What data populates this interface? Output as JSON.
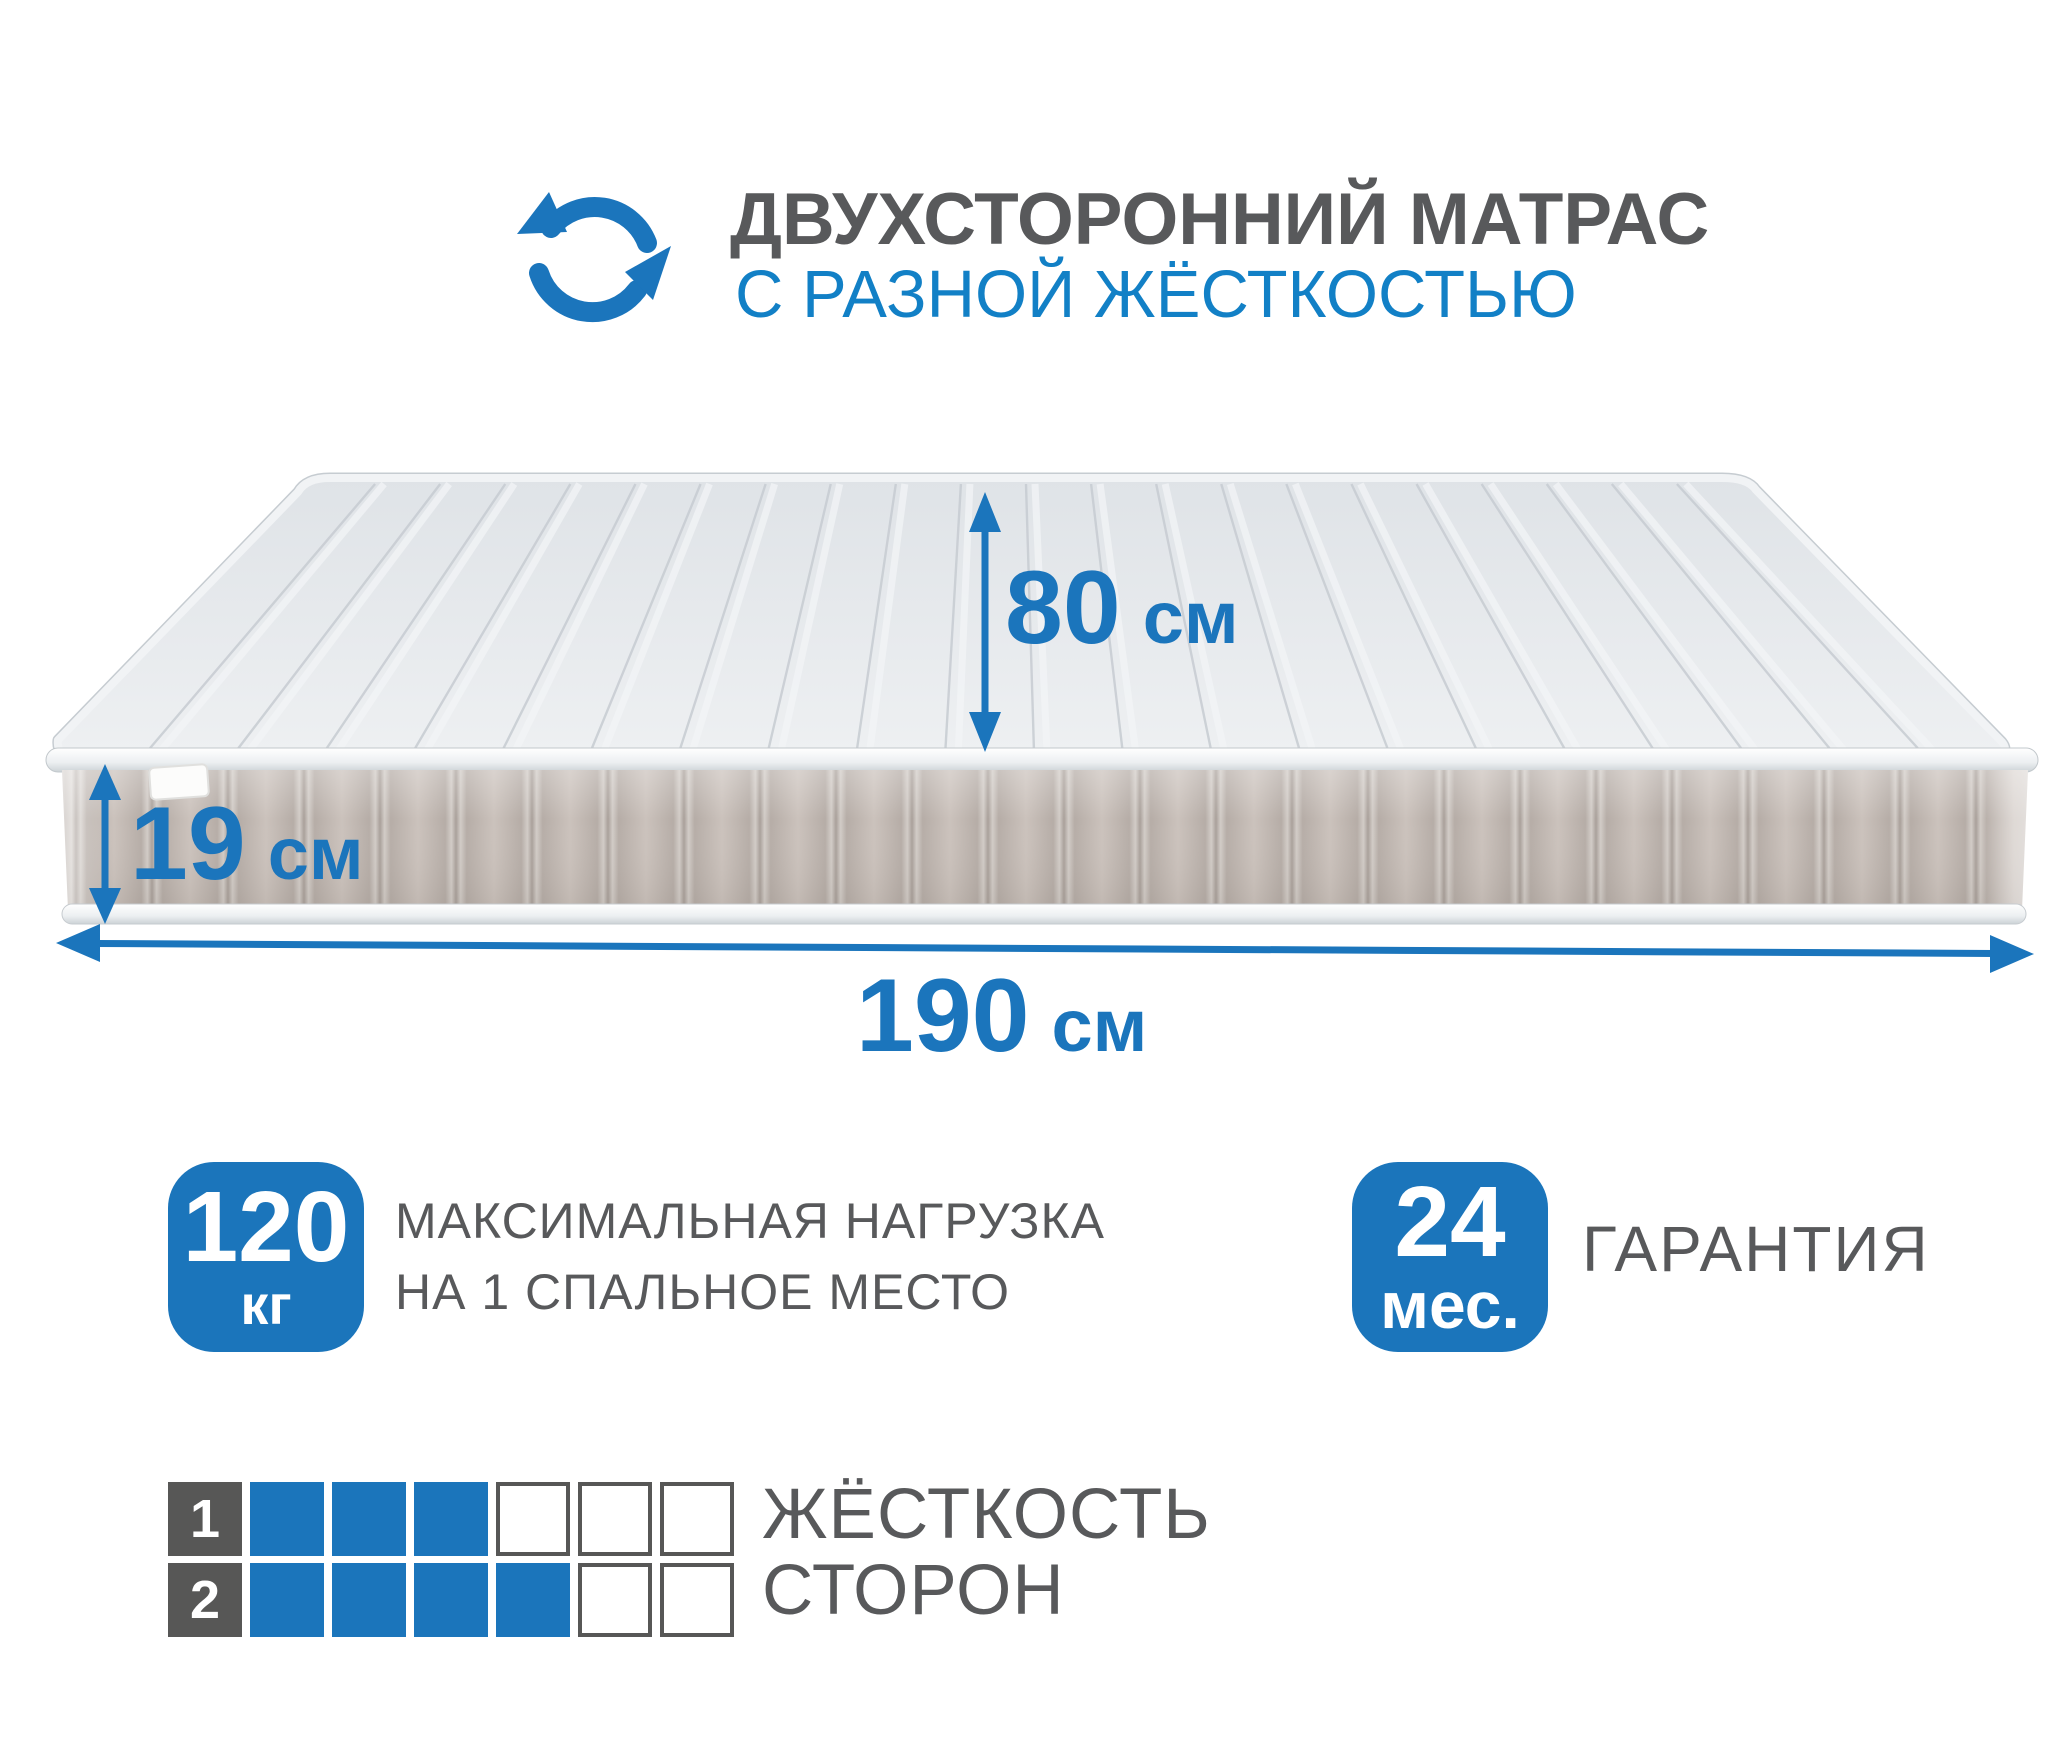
{
  "colors": {
    "accent": "#1b75bc",
    "accent_badge": "#1b75bb",
    "dark_text": "#58595b",
    "title_blue": "#1280c6",
    "mattress_side": "#c6bdb7",
    "mattress_top": "#e6e9ec"
  },
  "header": {
    "icon": "rotate-arrows-icon",
    "title_line1": "ДВУХСТОРОННИЙ МАТРАС",
    "title_line2": "С РАЗНОЙ ЖЁСТКОСТЬЮ"
  },
  "mattress": {
    "dimensions": {
      "width": {
        "value": "80",
        "unit": "см"
      },
      "height": {
        "value": "19",
        "unit": "см"
      },
      "length": {
        "value": "190",
        "unit": "см"
      }
    }
  },
  "badges": {
    "max_load": {
      "value": "120",
      "unit": "кг",
      "label_line1": "МАКСИМАЛЬНАЯ НАГРУЗКА",
      "label_line2": "НА 1 СПАЛЬНОЕ МЕСТО"
    },
    "warranty": {
      "value": "24",
      "unit": "мес.",
      "label": "ГАРАНТИЯ"
    }
  },
  "hardness": {
    "caption_line1": "ЖЁСТКОСТЬ",
    "caption_line2": "СТОРОН",
    "scale_max": 6,
    "rows": [
      {
        "side": "1",
        "filled": 3
      },
      {
        "side": "2",
        "filled": 4
      }
    ]
  }
}
